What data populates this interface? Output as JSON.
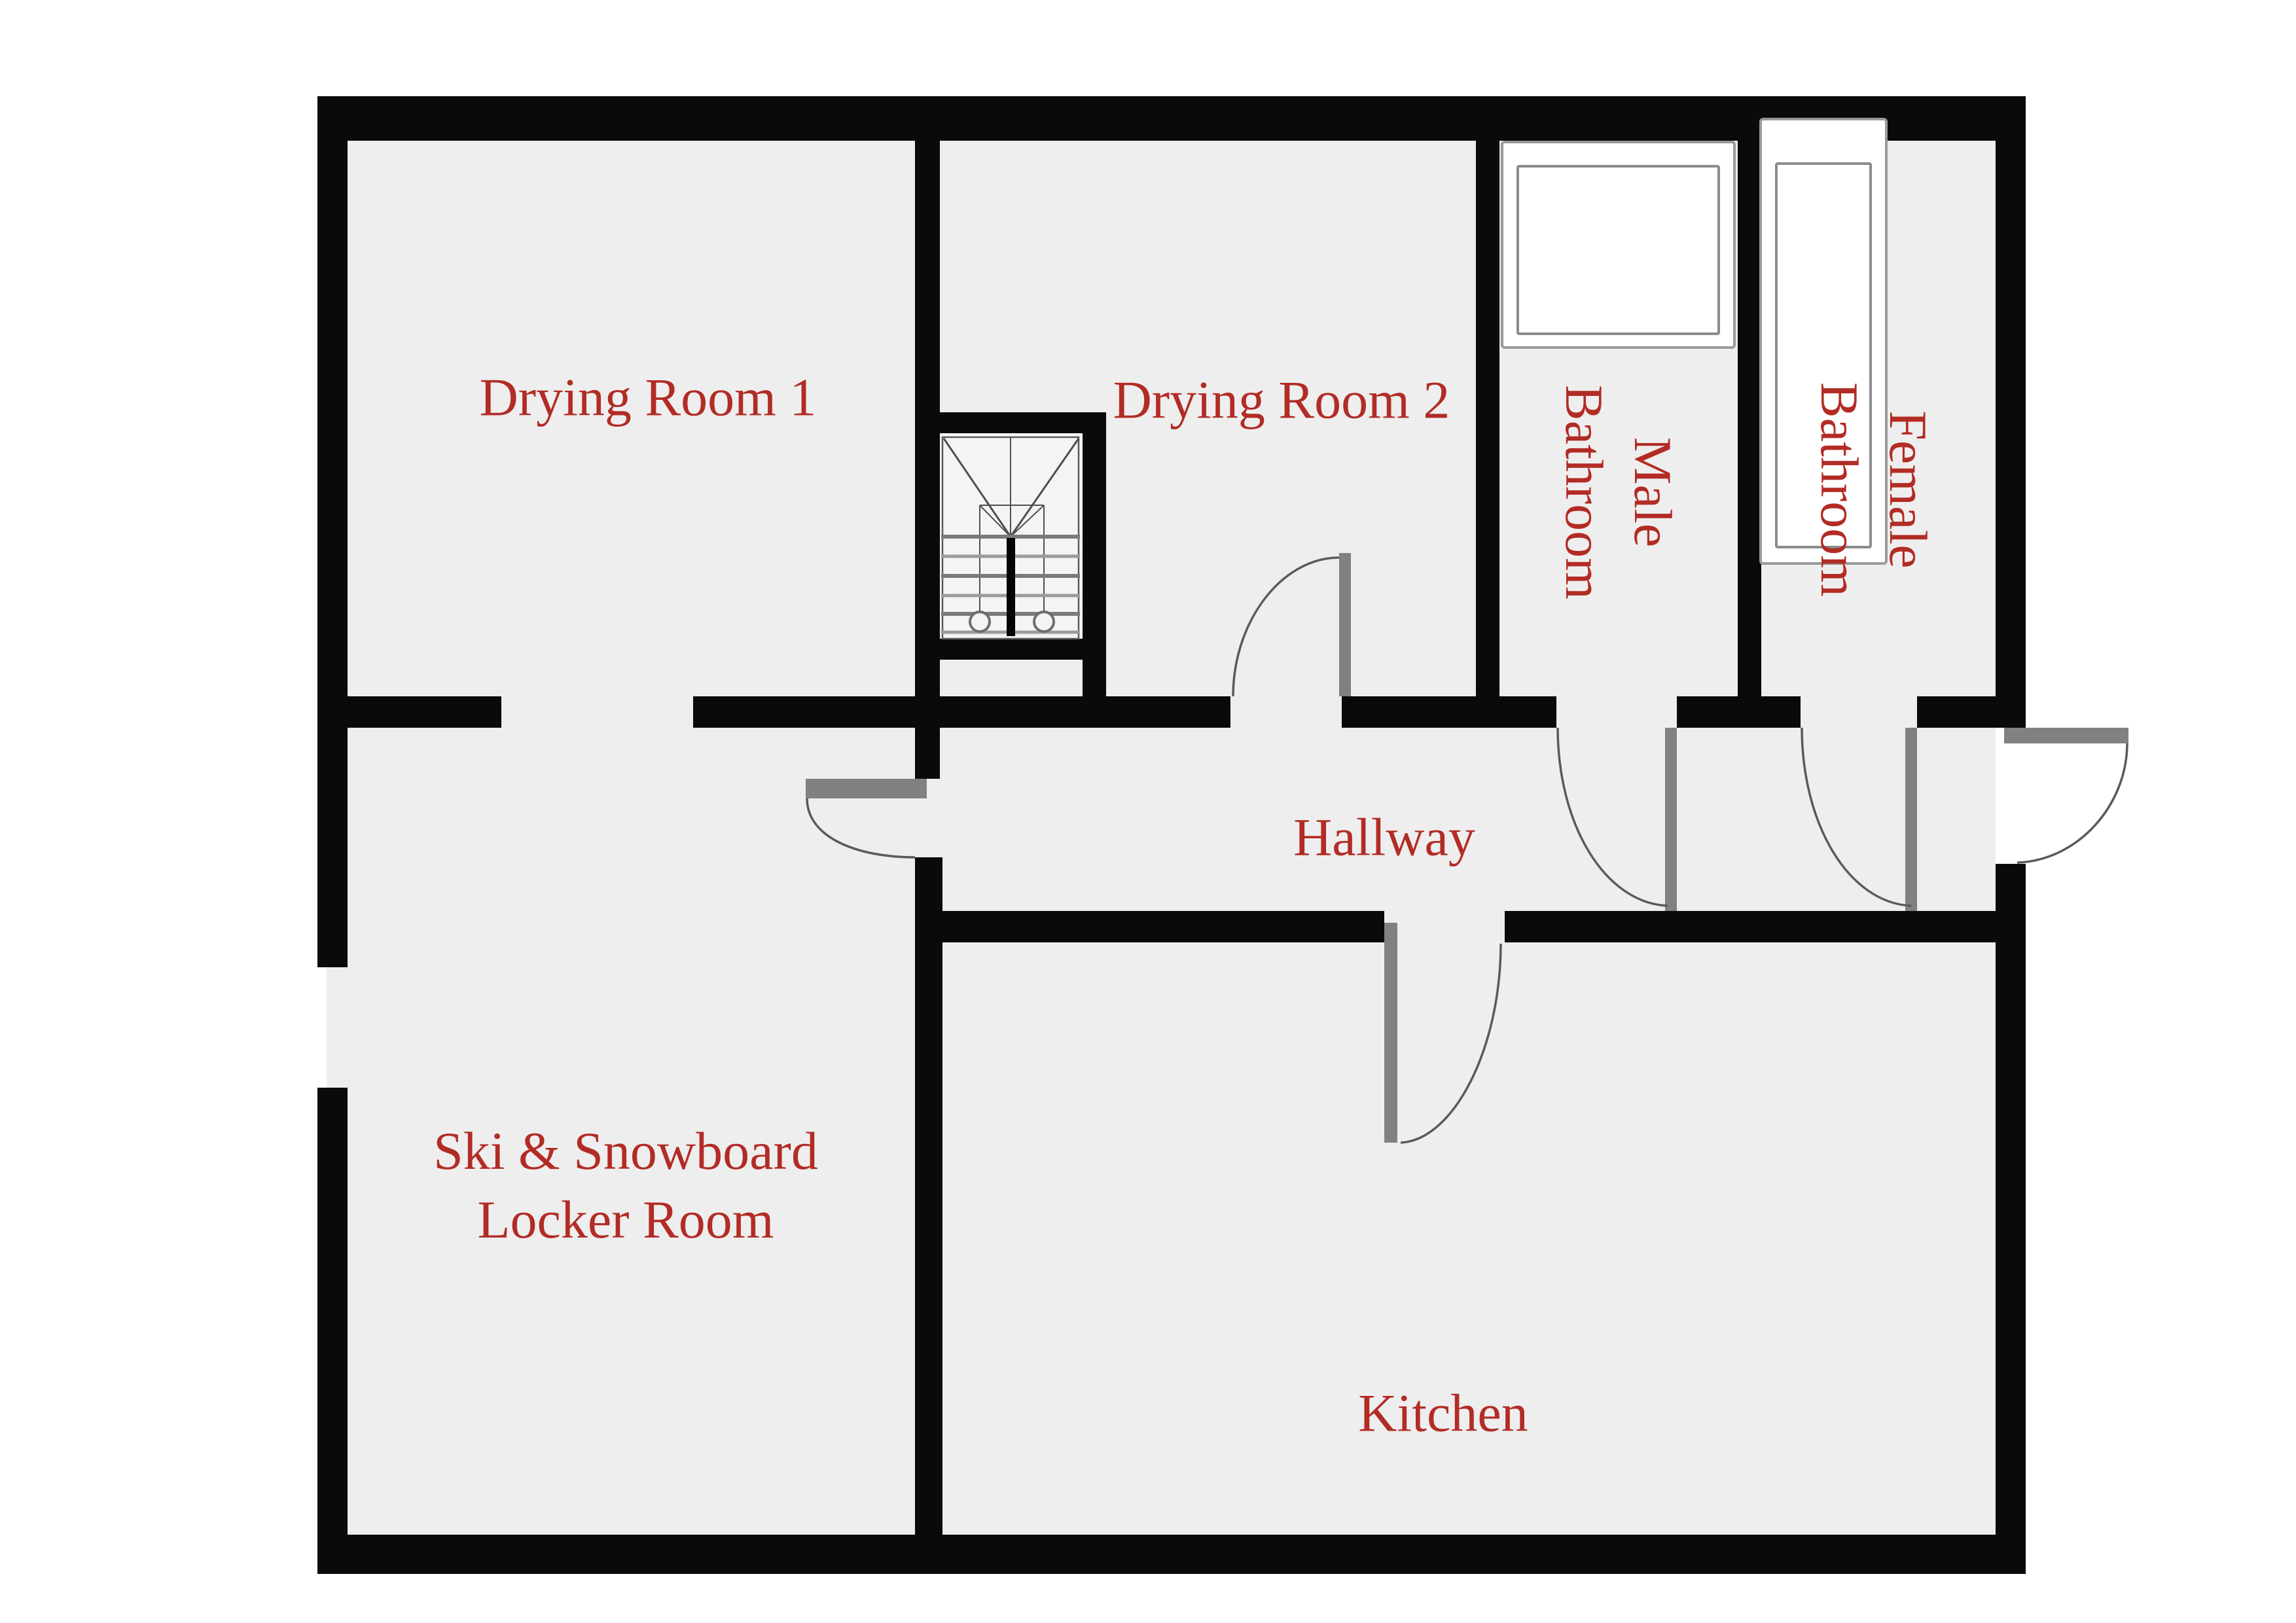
{
  "document_title": "Chalet lower floor plan",
  "colors": {
    "wall": "#0a0a0a",
    "floor": "#efeeee",
    "stair_floor": "#f5f4f4",
    "door": "#818181",
    "arc": "#5a5a5a",
    "label": "#b22c25",
    "background": "#ffffff",
    "fixture_border": "#9a9a9a"
  },
  "rooms": [
    {
      "id": "drying-room-1",
      "label": "Drying Room 1"
    },
    {
      "id": "drying-room-2",
      "label": "Drying Room 2"
    },
    {
      "id": "male-bathroom",
      "label": "Male Bathroom",
      "orientation": "rotated-90"
    },
    {
      "id": "female-bathroom",
      "label": "Female Bathroom",
      "orientation": "rotated-90"
    },
    {
      "id": "hallway",
      "label": "Hallway"
    },
    {
      "id": "locker-room",
      "label": "Ski & Snowboard Locker Room"
    },
    {
      "id": "kitchen",
      "label": "Kitchen"
    }
  ],
  "features": {
    "staircase": {
      "id": "staircase",
      "location": "between Drying Room 1 and Drying Room 2",
      "tread_count": 6,
      "newel_circles": 2
    },
    "doors": [
      {
        "id": "locker-room-hallway-door",
        "swing": "into locker room"
      },
      {
        "id": "drying-room-2-door",
        "swing": "into drying room 2"
      },
      {
        "id": "male-bathroom-door",
        "swing": "into hallway"
      },
      {
        "id": "female-bathroom-door",
        "swing": "into hallway"
      },
      {
        "id": "kitchen-door",
        "swing": "into kitchen"
      },
      {
        "id": "exterior-exit-door",
        "swing": "outward right"
      }
    ],
    "wall_openings": [
      {
        "id": "drying-room-1-locker-room-passage",
        "wall": "hallway top wall left"
      },
      {
        "id": "left-exterior-wall-opening",
        "wall": "left exterior wall"
      }
    ],
    "fixtures": [
      {
        "id": "male-bathroom-fixture"
      },
      {
        "id": "female-bathroom-fixture"
      }
    ]
  }
}
